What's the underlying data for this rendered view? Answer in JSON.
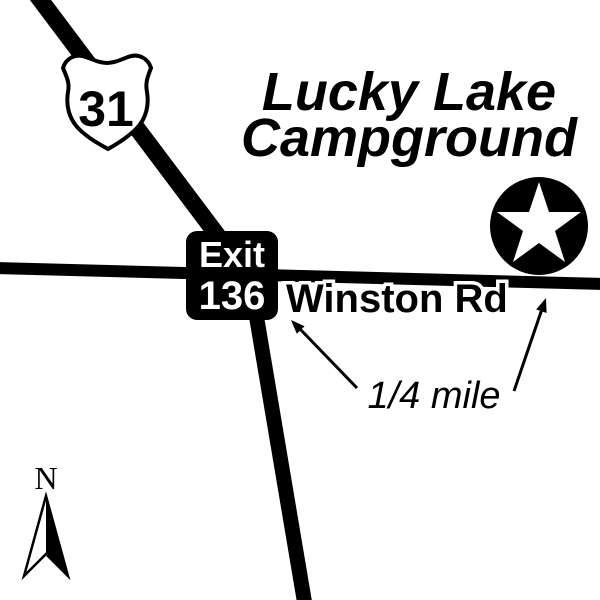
{
  "map": {
    "title": {
      "line1": "Lucky Lake",
      "line2": "Campground"
    },
    "highway_shield": {
      "type": "US route shield",
      "number": "31"
    },
    "exit_sign": {
      "line1": "Exit",
      "line2": "136"
    },
    "roads": {
      "cross_road_label": "Winston Rd"
    },
    "distance": {
      "label": "1/4 mile"
    },
    "compass": {
      "north_label": "N"
    },
    "icons": {
      "destination_marker": "star-in-circle-icon",
      "compass": "north-arrow-icon"
    },
    "colors": {
      "ink": "#000000",
      "background": "#ffffff"
    }
  }
}
